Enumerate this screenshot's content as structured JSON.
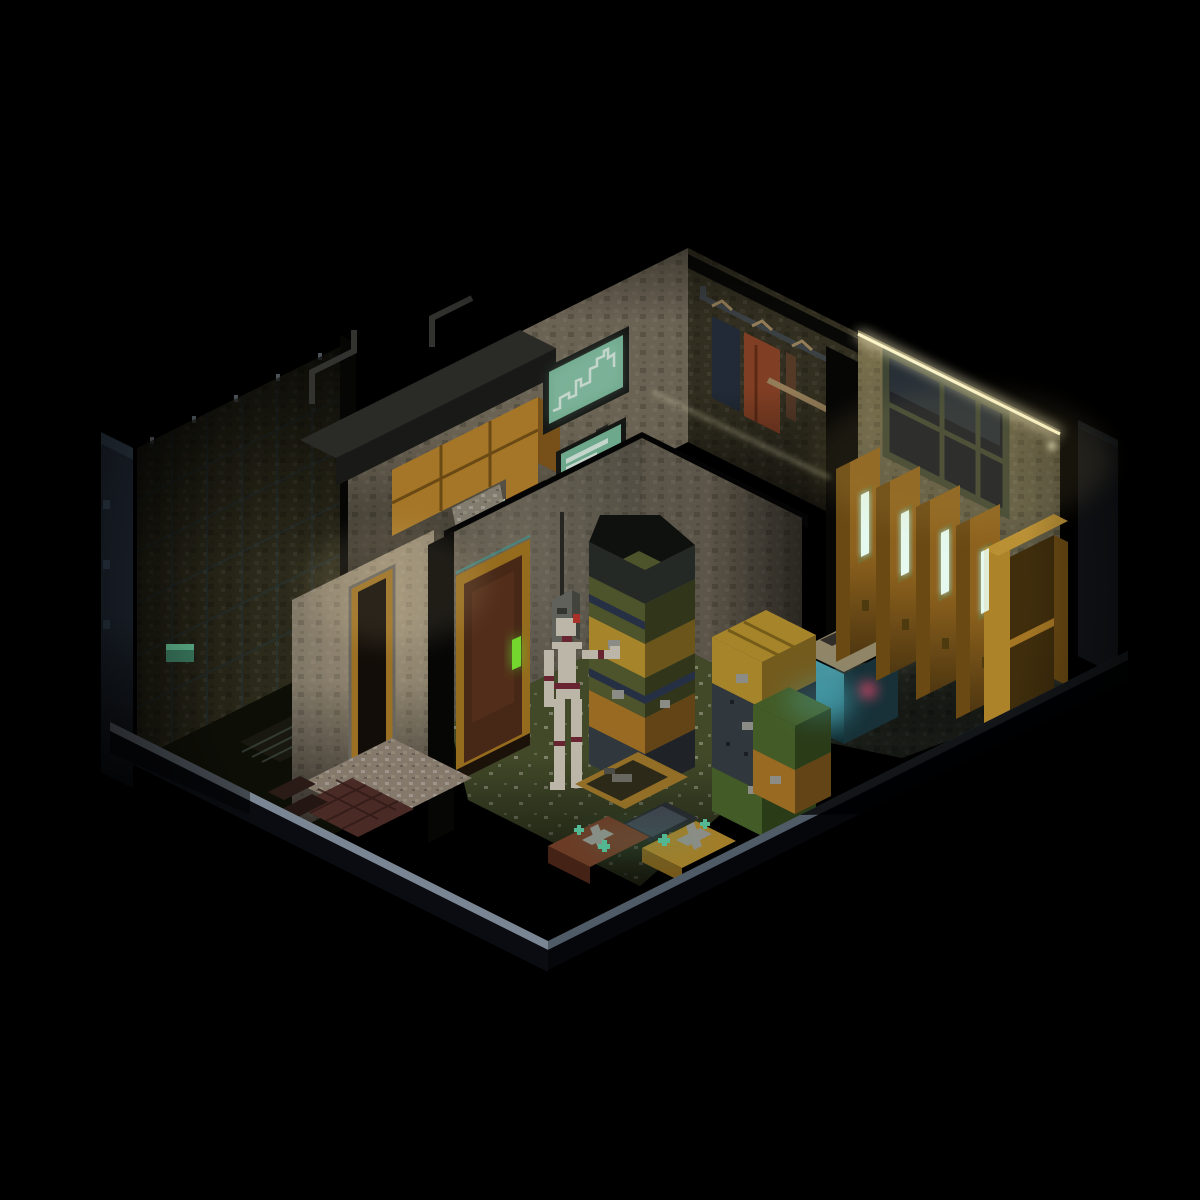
{
  "canvas": {
    "width": 1200,
    "height": 1200,
    "background": "#000000"
  },
  "scene": {
    "name": "isometric-voxel-apartment-cutaway",
    "description": "Dark isometric voxel cutaway of a small apartment: unlit tiled room, kitchen nook with wall monitors, wardrobe nook with hanging coats, locker room with glowing lockers and ceiling light strip, storage room stacked with crates, and a hallway entry on a floating floor slab.",
    "rooms": [
      {
        "id": "dark-room",
        "label": "Unlit tiled room"
      },
      {
        "id": "kitchen",
        "label": "Kitchen nook"
      },
      {
        "id": "wardrobe",
        "label": "Wardrobe nook"
      },
      {
        "id": "locker-room",
        "label": "Locker room"
      },
      {
        "id": "storage-room",
        "label": "Storage room"
      },
      {
        "id": "hallway",
        "label": "Hallway entry"
      }
    ],
    "objects": [
      {
        "id": "wall-monitor-chart",
        "label": "Wall monitor showing line chart"
      },
      {
        "id": "wall-monitor-text",
        "label": "Wall monitor showing text readout"
      },
      {
        "id": "kitchen-cabinets",
        "label": "Amber kitchen cabinets"
      },
      {
        "id": "range-hood",
        "label": "Dark counter hood"
      },
      {
        "id": "stove",
        "label": "Teal stove with mint display"
      },
      {
        "id": "coat-rack",
        "label": "Coat rack with hanging garments",
        "count": 3
      },
      {
        "id": "ceiling-light-strip",
        "label": "Warm glowing ceiling light strip"
      },
      {
        "id": "window",
        "label": "Dark paned window"
      },
      {
        "id": "lockers",
        "label": "Amber lockers with glowing vents",
        "count": 4
      },
      {
        "id": "open-locker",
        "label": "Open locker cabinet with shelf"
      },
      {
        "id": "aquarium",
        "label": "Glowing aquarium tank"
      },
      {
        "id": "crate-stacks",
        "label": "Stacked supply crates",
        "count": 12
      },
      {
        "id": "mannequin",
        "label": "Jointed bone-white mannequin with maroon bands"
      },
      {
        "id": "storage-door",
        "label": "Wooden door with glowing green handle"
      },
      {
        "id": "hall-door-frame",
        "label": "Amber hallway door frame"
      },
      {
        "id": "electrical-box",
        "label": "Wall electrical box with cable"
      },
      {
        "id": "floor-cases",
        "label": "Latched cases on the floor",
        "count": 2
      },
      {
        "id": "open-tray",
        "label": "Open amber tray crate"
      },
      {
        "id": "laptop",
        "label": "Flat dark slab device"
      },
      {
        "id": "glow-moss",
        "label": "Teal glowing moss patches"
      },
      {
        "id": "workbench",
        "label": "Workbench with teal machines"
      },
      {
        "id": "platform",
        "label": "Cutaway floor slab with pale rim"
      }
    ]
  },
  "palette": {
    "bg": "#000000",
    "rim_light": "#8e9dac",
    "rim_dim": "#5c6a77",
    "plat_side": "#0c0f14",
    "plat_side2": "#07090d",
    "cut_slab": "#232c38",
    "cut_slab_top": "#33404e",
    "right_slab": "#15181d",
    "right_slab_top": "#1d2127",
    "tile_wall": "#343220",
    "tile_grid": "#2c3f47",
    "peg": "#9fb0ba",
    "dark_floor": "#101108",
    "bench": "#1d1c13",
    "machine_teal": "#3e8166",
    "machine_teal_hi": "#64bd92",
    "machine_dark": "#3f2520",
    "machine_rail": "#5c6e66",
    "kitchen_wall": "#7c7361",
    "hood_top": "#31312d",
    "hood_front": "#1e1e1b",
    "pipe": "#3b3b37",
    "cabinet_front": "#c18a2e",
    "cabinet_side": "#8a5e1d",
    "cabinet_line": "#7d5519",
    "stove_body": "#3f9d85",
    "stove_band": "#2e7261",
    "display_mint": "#d9f6e8",
    "rubble": "#97917f",
    "fridge_teal": "#58b7a7",
    "kitchen_door": "#553723",
    "doorway_dark": "#1a1008",
    "monitor_frame": "#191b18",
    "screen_teal": "#7fc3a3",
    "screen_line": "#e5f9ee",
    "cable": "#2c2c28",
    "pink_poster": "#c2677c",
    "closet_wall": "#3b3726",
    "closet_beam": "#0a0a08",
    "rail": "#454b50",
    "hanger_wood": "#ac9267",
    "coat_navy": "#27313f",
    "coat_rust": "#95492a",
    "coat_brown": "#63432e",
    "locker_wall": "#6f6950",
    "window_frame": "#4a523c",
    "window_pane": "#20242c",
    "window_sheen": "#39444f",
    "strip_glow": "#fff7cb",
    "locker_front": "#a57323",
    "locker_side": "#7c5517",
    "locker_top": "#d9a83e",
    "slit_frame": "#8f7d33",
    "slit_glow": "#eafff4",
    "locker_handle": "#5a4512",
    "open_locker_in": "#4a350f",
    "locker_shelf": "#bf8a2b",
    "open_door": "#c9992f",
    "locker_floor": "#373d32",
    "aqua_lid": "#a89b78",
    "aqua_lid_dark": "#3a3630",
    "aqua_glass": "#2e6f7c",
    "aqua_glass_dark": "#1c3a42",
    "aqua_glow": "#55c7d9",
    "coral_pink": "#d14b6c",
    "store_wall_l": "#5c574b",
    "store_wall_r": "#6c6455",
    "store_floor": "#4c5530",
    "door_frame": "#ae7d23",
    "door_panel": "#532f1b",
    "door_panel_hi": "#6b3d22",
    "door_glint": "#4aa89f",
    "handle_green": "#75da2f",
    "elec_box": "#71716a",
    "crate_olive": "#5a6132",
    "crate_navy": "#2c3950",
    "crate_mustard": "#c19a31",
    "crate_charcoal": "#394047",
    "crate_amber": "#b27c28",
    "crate_green": "#4e6a2d",
    "crate_dark": "#2b302c",
    "latch_gray": "#a4a49c",
    "stud_dark": "#1f242a",
    "bone": "#dad4c4",
    "band_maroon": "#7b2a3a",
    "crest_red": "#c53a31",
    "tray_amber": "#aa812d",
    "tray_inner": "#35301c",
    "tool_gray": "#7a7a72",
    "laptop_dark": "#2c3136",
    "laptop_sheen": "#4b535d",
    "case_brown": "#7d452c",
    "case_mustard": "#bc9230",
    "moss_teal": "#63d7ad",
    "hall_wall": "#8d8372",
    "hall_frame": "#b5832a",
    "hall_trim": "#7a766c",
    "hall_floor": "#9a8d7d",
    "mat_brick": "#56312b",
    "mat_line": "#381f1b",
    "brick_dark": "#33201b",
    "black_edge": "#070706"
  }
}
